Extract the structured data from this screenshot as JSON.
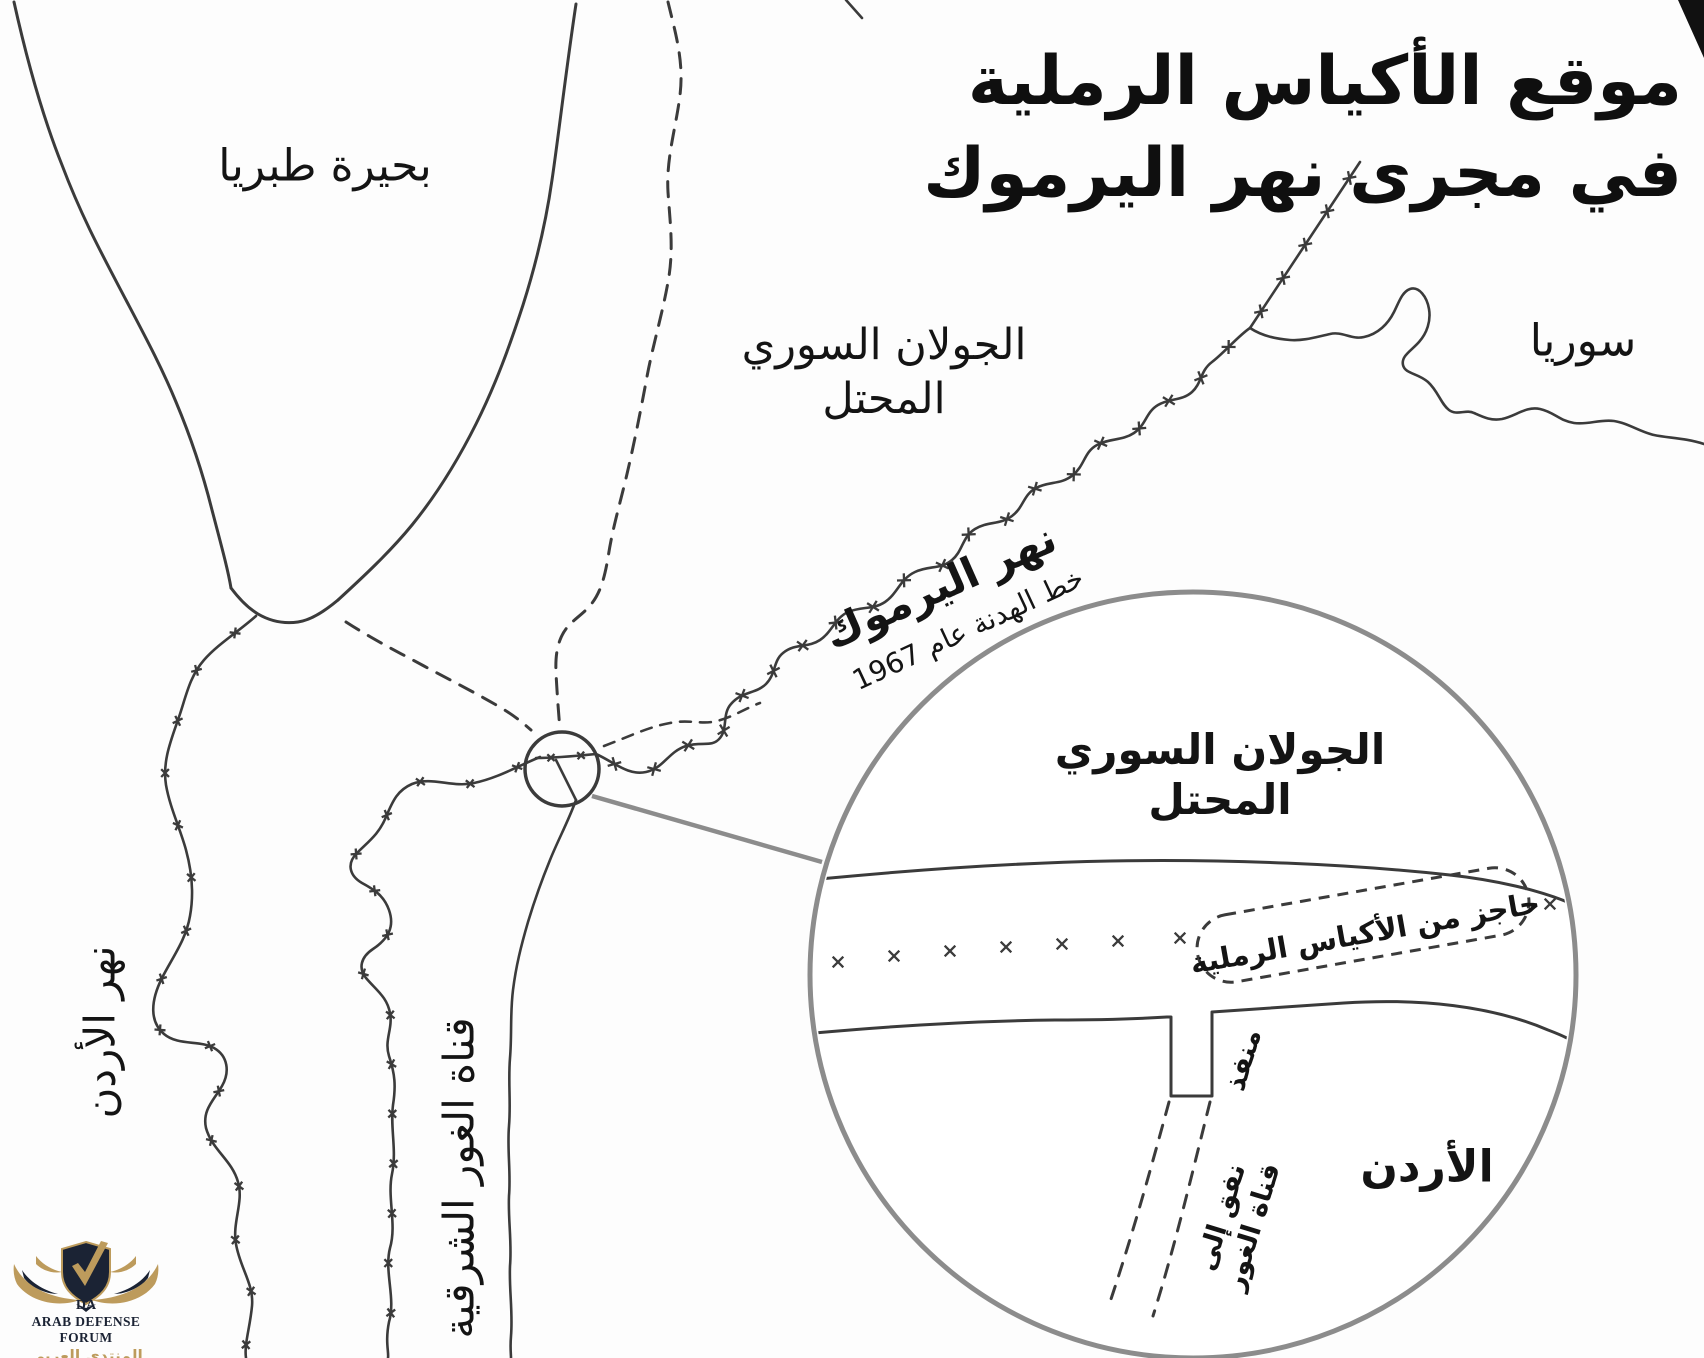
{
  "title": {
    "line1": "موقع الأكياس الرملية",
    "line2": "في مجرى نهر اليرموك"
  },
  "map_labels": {
    "lake_tiberias": "بحيرة طبريا",
    "golan_line1": "الجولان السوري",
    "golan_line2": "المحتل",
    "syria": "سوريا",
    "yarmouk_river": "نهر اليرموك",
    "armistice_line_1967": "خط الهدنة عام 1967",
    "jordan_river": "نهر الأردن",
    "east_ghor_canal": "قناة الغور الشرقية"
  },
  "inset_labels": {
    "golan_line1": "الجولان السوري",
    "golan_line2": "المحتل",
    "sandbag_barrier": "حاجز من الأكياس الرملية",
    "outlet": "منفذ",
    "tunnel_line1": "نفق إلى",
    "tunnel_line2": "قناة الغور",
    "jordan": "الأردن"
  },
  "logo": {
    "monogram": "DA",
    "name_en": "ARAB DEFENSE FORUM",
    "name_ar": "المنتدى العربي للدفاع والتسليح"
  },
  "colors": {
    "line": "#3b3b3b",
    "circle_gray": "#8c8c8c",
    "text": "#141414",
    "logo_navy": "#1b2334",
    "logo_gold": "#bd9b5c"
  }
}
